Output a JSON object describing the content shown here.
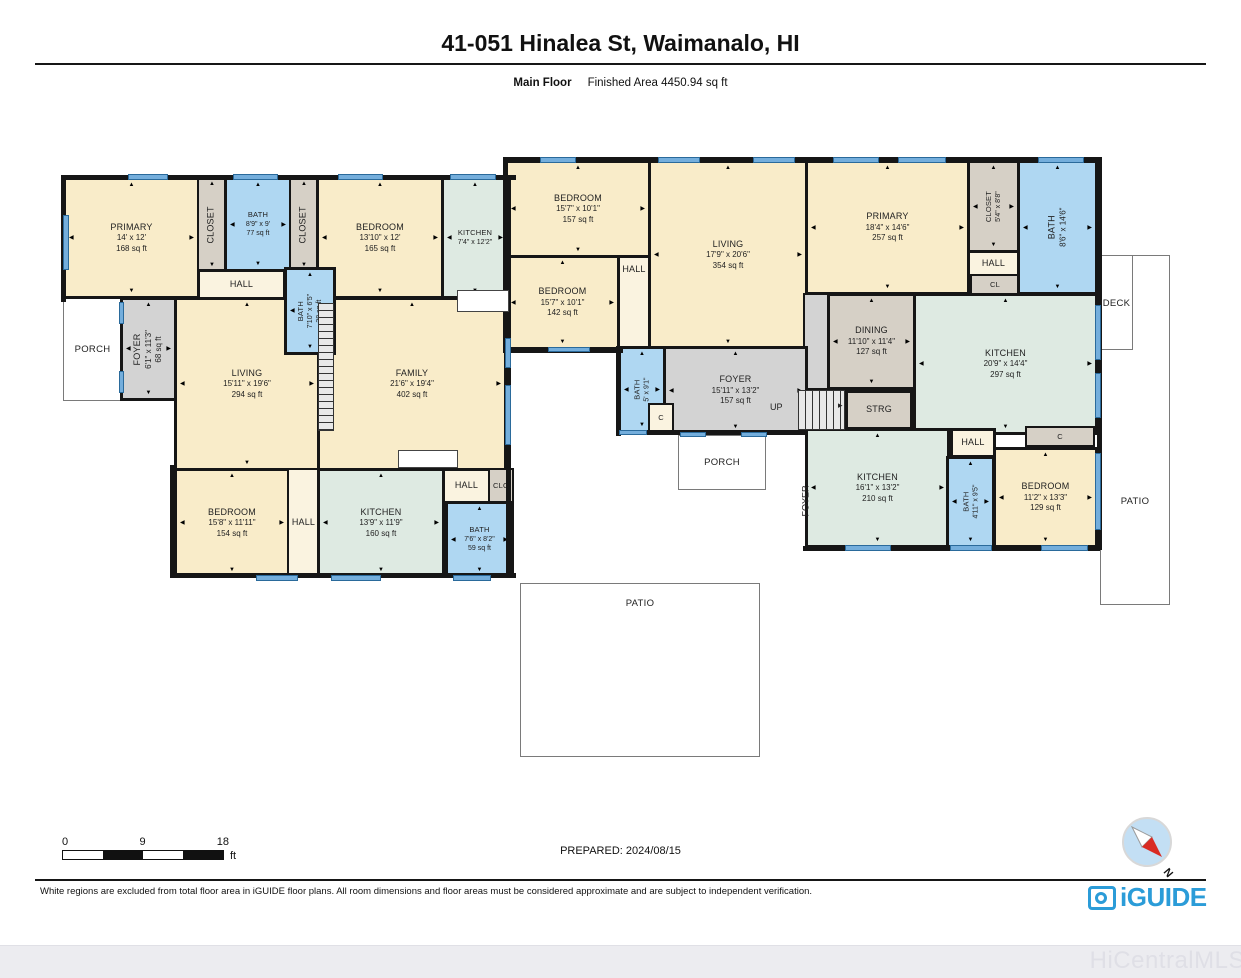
{
  "header": {
    "title": "41-051 Hinalea St, Waimanalo, HI",
    "floor_label": "Main Floor",
    "finished_area": "Finished Area 4450.94 sq ft"
  },
  "footer": {
    "prepared": "PREPARED: 2024/08/15",
    "disclaimer": "White regions are excluded from total floor area in iGUIDE floor plans. All room dimensions and floor areas must be considered approximate and are subject to independent verification.",
    "scale": {
      "start": "0",
      "mid": "9",
      "end": "18",
      "unit": "ft"
    },
    "brand": "iGUIDE",
    "watermark": "HiCentralMLS",
    "compass_label": "N"
  },
  "colors": {
    "cream": "#F9ECC9",
    "hall": "#FAF3E0",
    "blue": "#AFD7F2",
    "tan": "#D6D0C6",
    "gray": "#D3D3D3",
    "green": "#DEEAE2",
    "wall": "#161616",
    "window": "#74AEDC",
    "brand_blue": "#2B9CD8",
    "compass_red": "#D92B23"
  },
  "floorplan": {
    "outdoor": [
      {
        "id": "patio-right",
        "label": "PATIO",
        "x": 1100,
        "y": 255,
        "w": 70,
        "h": 350,
        "ly": 240
      },
      {
        "id": "deck",
        "label": "DECK",
        "x": 1100,
        "y": 255,
        "w": 33,
        "h": 95,
        "ly": 42
      },
      {
        "id": "patio-bottom",
        "label": "PATIO",
        "x": 520,
        "y": 583,
        "w": 240,
        "h": 174,
        "ly": 14
      },
      {
        "id": "porch-left",
        "label": "PORCH",
        "x": 63,
        "y": 297,
        "w": 59,
        "h": 104
      },
      {
        "id": "porch-right",
        "label": "PORCH",
        "x": 678,
        "y": 435,
        "w": 88,
        "h": 55
      }
    ],
    "rooms": [
      {
        "id": "primary-1",
        "lines": [
          "PRIMARY",
          "14' x 12'",
          "168 sq ft"
        ],
        "x": 63,
        "y": 177,
        "w": 137,
        "h": 122,
        "fill": "cream"
      },
      {
        "id": "closet-1",
        "lines": [
          "CLOSET"
        ],
        "x": 197,
        "y": 177,
        "w": 30,
        "h": 95,
        "fill": "tan",
        "vert": true
      },
      {
        "id": "bath-1",
        "lines": [
          "BATH",
          "8'9\" x 9'",
          "77 sq ft"
        ],
        "x": 224,
        "y": 177,
        "w": 68,
        "h": 95,
        "fill": "blue",
        "tiny": true
      },
      {
        "id": "closet-2",
        "lines": [
          "CLOSET"
        ],
        "x": 289,
        "y": 177,
        "w": 30,
        "h": 95,
        "fill": "tan",
        "vert": true
      },
      {
        "id": "bedroom-1",
        "lines": [
          "BEDROOM",
          "13'10\" x 12'",
          "165 sq ft"
        ],
        "x": 316,
        "y": 177,
        "w": 128,
        "h": 122,
        "fill": "cream"
      },
      {
        "id": "kitchen-1",
        "lines": [
          "KITCHEN",
          "7'4\" x 12'2\""
        ],
        "x": 441,
        "y": 177,
        "w": 68,
        "h": 122,
        "fill": "green",
        "tiny": true
      },
      {
        "id": "hall-1",
        "lines": [
          "HALL"
        ],
        "x": 197,
        "y": 269,
        "w": 89,
        "h": 31,
        "fill": "hall",
        "arrows": false
      },
      {
        "id": "foyer-1",
        "lines": [
          "FOYER",
          "6'1\" x 11'3\"",
          "68 sq ft"
        ],
        "x": 120,
        "y": 297,
        "w": 57,
        "h": 104,
        "fill": "gray",
        "vert": true
      },
      {
        "id": "living-1",
        "lines": [
          "LIVING",
          "15'11\" x 19'6\"",
          "294 sq ft"
        ],
        "x": 174,
        "y": 297,
        "w": 146,
        "h": 174,
        "fill": "cream"
      },
      {
        "id": "family",
        "lines": [
          "FAMILY",
          "21'6\" x 19'4\"",
          "402 sq ft"
        ],
        "x": 317,
        "y": 297,
        "w": 190,
        "h": 174,
        "fill": "cream"
      },
      {
        "id": "bath-2",
        "lines": [
          "BATH",
          "7'10\" x 6'5\"",
          "38 sq ft"
        ],
        "x": 284,
        "y": 267,
        "w": 52,
        "h": 88,
        "fill": "blue",
        "vert": true,
        "tiny": true
      },
      {
        "id": "bedroom-2",
        "lines": [
          "BEDROOM",
          "15'8\" x 11'11\"",
          "154 sq ft"
        ],
        "x": 174,
        "y": 468,
        "w": 116,
        "h": 110,
        "fill": "cream"
      },
      {
        "id": "hall-2",
        "lines": [
          "HALL"
        ],
        "x": 287,
        "y": 468,
        "w": 33,
        "h": 110,
        "fill": "hall",
        "arrows": false
      },
      {
        "id": "kitchen-2",
        "lines": [
          "KITCHEN",
          "13'9\" x 11'9\"",
          "160 sq ft"
        ],
        "x": 317,
        "y": 468,
        "w": 128,
        "h": 110,
        "fill": "green"
      },
      {
        "id": "hall-3",
        "lines": [
          "HALL"
        ],
        "x": 442,
        "y": 468,
        "w": 49,
        "h": 36,
        "fill": "hall",
        "arrows": false
      },
      {
        "id": "clo",
        "lines": [
          "CLO"
        ],
        "x": 488,
        "y": 468,
        "w": 26,
        "h": 36,
        "fill": "tan",
        "arrows": false,
        "tiny": true
      },
      {
        "id": "bath-3",
        "lines": [
          "BATH",
          "7'6\" x 8'2\"",
          "59 sq ft"
        ],
        "x": 445,
        "y": 501,
        "w": 69,
        "h": 77,
        "fill": "blue",
        "tiny": true
      },
      {
        "id": "bedroom-3",
        "lines": [
          "BEDROOM",
          "15'7\" x 10'1\"",
          "157 sq ft"
        ],
        "x": 505,
        "y": 160,
        "w": 146,
        "h": 98,
        "fill": "cream"
      },
      {
        "id": "bedroom-4",
        "lines": [
          "BEDROOM",
          "15'7\" x 10'1\"",
          "142 sq ft"
        ],
        "x": 505,
        "y": 255,
        "w": 115,
        "h": 95,
        "fill": "cream"
      },
      {
        "id": "hall-4",
        "lines": [
          "HALL"
        ],
        "x": 617,
        "y": 255,
        "w": 34,
        "h": 95,
        "fill": "hall",
        "arrows": false,
        "top": true
      },
      {
        "id": "living-2",
        "lines": [
          "LIVING",
          "17'9\" x 20'6\"",
          "354 sq ft"
        ],
        "x": 648,
        "y": 160,
        "w": 160,
        "h": 190,
        "fill": "cream"
      },
      {
        "id": "primary-2",
        "lines": [
          "PRIMARY",
          "18'4\" x 14'6\"",
          "257 sq ft"
        ],
        "x": 805,
        "y": 160,
        "w": 165,
        "h": 135,
        "fill": "cream"
      },
      {
        "id": "closet-3",
        "lines": [
          "CLOSET",
          "5'4\" x 8'8\""
        ],
        "x": 967,
        "y": 160,
        "w": 53,
        "h": 93,
        "fill": "tan",
        "vert": true,
        "tiny": true
      },
      {
        "id": "hall-5",
        "lines": [
          "HALL"
        ],
        "x": 967,
        "y": 250,
        "w": 53,
        "h": 28,
        "fill": "hall",
        "arrows": false
      },
      {
        "id": "cl",
        "lines": [
          "CL"
        ],
        "x": 970,
        "y": 274,
        "w": 50,
        "h": 21,
        "fill": "tan",
        "arrows": false,
        "tiny": true
      },
      {
        "id": "bath-4",
        "lines": [
          "BATH",
          "8'6\" x 14'6\""
        ],
        "x": 1017,
        "y": 160,
        "w": 81,
        "h": 135,
        "fill": "blue",
        "vert": true
      },
      {
        "id": "landing",
        "lines": [],
        "x": 803,
        "y": 293,
        "w": 27,
        "h": 97,
        "fill": "gray",
        "arrows": false
      },
      {
        "id": "dining",
        "lines": [
          "DINING",
          "11'10\" x 11'4\"",
          "127 sq ft"
        ],
        "x": 827,
        "y": 293,
        "w": 89,
        "h": 97,
        "fill": "tan"
      },
      {
        "id": "kitchen-3",
        "lines": [
          "KITCHEN",
          "20'9\" x 14'4\"",
          "297 sq ft"
        ],
        "x": 913,
        "y": 293,
        "w": 185,
        "h": 142,
        "fill": "green"
      },
      {
        "id": "strg",
        "lines": [
          "STRG"
        ],
        "x": 845,
        "y": 390,
        "w": 68,
        "h": 40,
        "fill": "tan",
        "arrows": false
      },
      {
        "id": "bath-5",
        "lines": [
          "BATH",
          "5' x 9'1\""
        ],
        "x": 618,
        "y": 346,
        "w": 48,
        "h": 87,
        "fill": "blue",
        "vert": true,
        "tiny": true
      },
      {
        "id": "foyer-2",
        "lines": [
          "FOYER",
          "15'11\" x 13'2\"",
          "157 sq ft"
        ],
        "x": 663,
        "y": 346,
        "w": 145,
        "h": 89,
        "fill": "gray"
      },
      {
        "id": "c-1",
        "lines": [
          "C"
        ],
        "x": 648,
        "y": 403,
        "w": 26,
        "h": 30,
        "fill": "hall",
        "arrows": false,
        "tiny": true
      },
      {
        "id": "kitchen-4",
        "lines": [
          "KITCHEN",
          "16'1\" x 13'2\"",
          "210 sq ft"
        ],
        "x": 805,
        "y": 428,
        "w": 145,
        "h": 120,
        "fill": "green"
      },
      {
        "id": "hall-6",
        "lines": [
          "HALL"
        ],
        "x": 950,
        "y": 428,
        "w": 46,
        "h": 30,
        "fill": "hall",
        "arrows": false
      },
      {
        "id": "c-2",
        "lines": [
          "C"
        ],
        "x": 1025,
        "y": 426,
        "w": 70,
        "h": 21,
        "fill": "tan",
        "arrows": false,
        "tiny": true
      },
      {
        "id": "bath-6",
        "lines": [
          "BATH",
          "4'11\" x 9'5\""
        ],
        "x": 946,
        "y": 456,
        "w": 49,
        "h": 92,
        "fill": "blue",
        "vert": true,
        "tiny": true
      },
      {
        "id": "bedroom-5",
        "lines": [
          "BEDROOM",
          "11'2\" x 13'3\"",
          "129 sq ft"
        ],
        "x": 993,
        "y": 447,
        "w": 105,
        "h": 101,
        "fill": "cream"
      }
    ],
    "walls": [
      [
        61,
        175,
        455,
        5
      ],
      [
        61,
        175,
        5,
        127
      ],
      [
        506,
        175,
        5,
        403
      ],
      [
        170,
        573,
        346,
        5
      ],
      [
        170,
        465,
        5,
        113
      ],
      [
        503,
        157,
        599,
        5
      ],
      [
        503,
        157,
        5,
        196
      ],
      [
        1097,
        157,
        5,
        393
      ],
      [
        803,
        546,
        297,
        5
      ],
      [
        503,
        348,
        120,
        5
      ],
      [
        616,
        346,
        5,
        90
      ],
      [
        616,
        430,
        54,
        5
      ],
      [
        663,
        430,
        145,
        5
      ]
    ],
    "windows": [
      [
        128,
        174,
        40,
        6
      ],
      [
        233,
        174,
        45,
        6
      ],
      [
        338,
        174,
        45,
        6
      ],
      [
        450,
        174,
        46,
        6
      ],
      [
        63,
        215,
        6,
        55
      ],
      [
        119,
        302,
        5,
        22
      ],
      [
        119,
        371,
        5,
        22
      ],
      [
        256,
        575,
        42,
        6
      ],
      [
        331,
        575,
        50,
        6
      ],
      [
        453,
        575,
        38,
        6
      ],
      [
        505,
        338,
        6,
        30
      ],
      [
        505,
        385,
        6,
        60
      ],
      [
        540,
        157,
        36,
        6
      ],
      [
        658,
        157,
        42,
        6
      ],
      [
        753,
        157,
        42,
        6
      ],
      [
        833,
        157,
        46,
        6
      ],
      [
        898,
        157,
        48,
        6
      ],
      [
        1038,
        157,
        46,
        6
      ],
      [
        548,
        347,
        42,
        5
      ],
      [
        619,
        430,
        28,
        5
      ],
      [
        680,
        432,
        26,
        5
      ],
      [
        741,
        432,
        26,
        5
      ],
      [
        845,
        545,
        46,
        6
      ],
      [
        950,
        545,
        42,
        6
      ],
      [
        1041,
        545,
        47,
        6
      ],
      [
        1095,
        305,
        6,
        55
      ],
      [
        1095,
        373,
        6,
        45
      ],
      [
        1095,
        453,
        6,
        77
      ]
    ],
    "fixtures": [
      [
        457,
        290,
        52,
        22
      ],
      [
        398,
        450,
        60,
        18
      ]
    ],
    "stairs": [
      {
        "x": 798,
        "y": 390,
        "w": 47,
        "h": 40,
        "dir": "v"
      },
      {
        "x": 318,
        "y": 303,
        "w": 16,
        "h": 128,
        "dir": "h"
      }
    ],
    "labels": [
      {
        "id": "up-label",
        "t": "UP",
        "x": 770,
        "y": 402
      },
      {
        "id": "up-arrow",
        "t": "▸",
        "x": 838,
        "y": 400
      },
      {
        "id": "foyer-3-label",
        "t": "FOYER",
        "x": 790,
        "y": 496,
        "vert": true
      }
    ]
  }
}
